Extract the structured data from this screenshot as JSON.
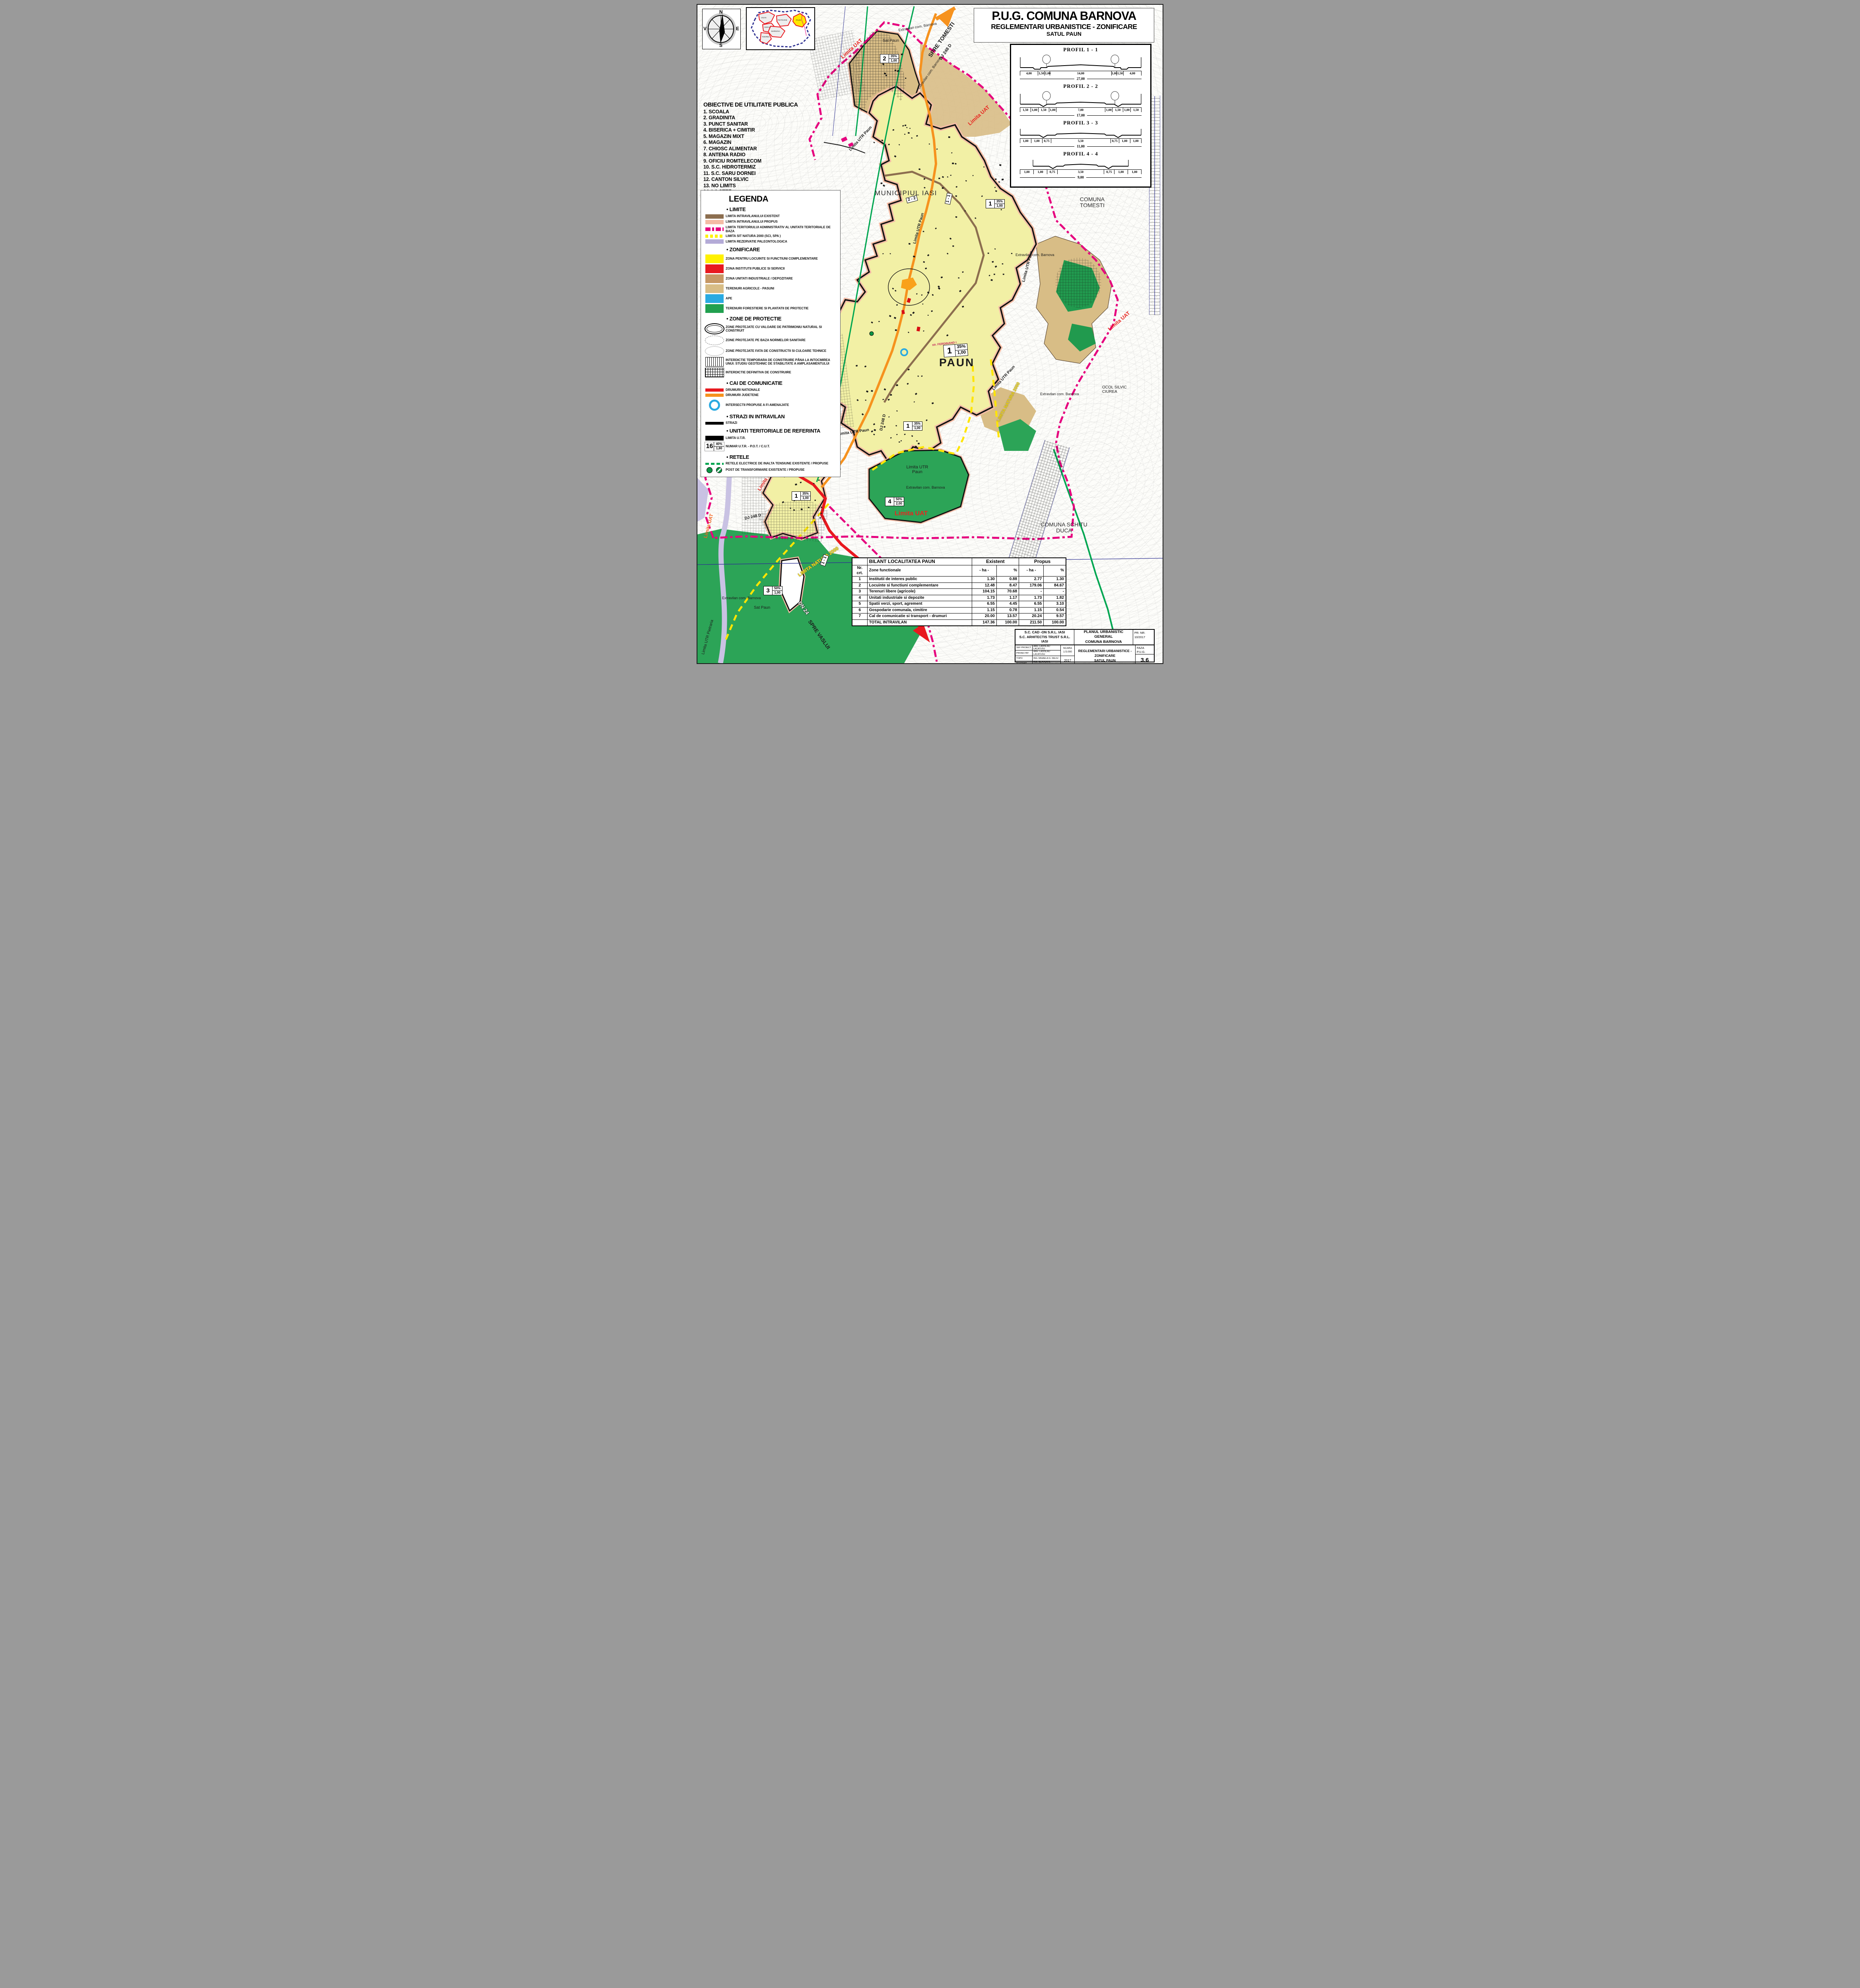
{
  "sheet": {
    "title_line1": "P.U.G. COMUNA BARNOVA",
    "title_line2": "REGLEMENTARI URBANISTICE - ZONIFICARE",
    "title_line3": "SATUL PAUN"
  },
  "compass": {
    "n": "N",
    "e": "E",
    "s": "S",
    "v": "V"
  },
  "inset_map": {
    "labels": [
      "VISAN",
      "CERCU",
      "PIETRARIE",
      "BARNOVA",
      "TODIREL",
      "PAUN"
    ]
  },
  "objectives": {
    "heading": "OBIECTIVE DE UTILITATE PUBLICA",
    "items": [
      "1. SCOALA",
      "2. GRADINITA",
      "3. PUNCT SANITAR",
      "4. BISERICA + CIMITIR",
      "5. MAGAZIN MIXT",
      "6. MAGAZIN",
      "7. CHIOSC ALIMENTAR",
      "8. ANTENA RADIO",
      "9. OFICIU ROMTELECOM",
      "10. S.C. HIDROTERMIZ",
      "11. S.C. SARU DORNEI",
      "12. CANTON SILVIC",
      "13. NO LIMITS",
      "14. LA STEF"
    ]
  },
  "profiles": {
    "items": [
      {
        "name": "PROFIL 1 - 1",
        "dims": [
          "4,00",
          "1,50",
          "1,00",
          "14,00",
          "1,00",
          "1,50",
          "4,00"
        ],
        "total": "27,00"
      },
      {
        "name": "PROFIL 2 - 2",
        "dims": [
          "1,50",
          "1,00",
          "1,50",
          "1,00",
          "7,00",
          "1,00",
          "1,50",
          "1,00",
          "1,50"
        ],
        "total": "17,00"
      },
      {
        "name": "PROFIL 3 - 3",
        "dims": [
          "1,00",
          "1,00",
          "0,75",
          "5,50",
          "0,75",
          "1,00",
          "1,00"
        ],
        "total": "11,00"
      },
      {
        "name": "PROFIL 4 - 4",
        "dims": [
          "1,00",
          "1,00",
          "0,75",
          "3,50",
          "0,75",
          "1,00",
          "1,00"
        ],
        "total": "9,00"
      }
    ]
  },
  "legend": {
    "heading": "LEGENDA",
    "h_limite": "• LIMITE",
    "limite": [
      {
        "label": "LIMITA INTRAVILANULUI EXISTENT",
        "swatch": "bar-brown"
      },
      {
        "label": "LIMITA INTRAVILANULUI PROPUS",
        "swatch": "bar-salmon"
      },
      {
        "label": "LIMITA TERITORIULUI ADMINISTRATIV AL UNITATII TERITORIALE DE BAZA",
        "swatch": "dash-magenta"
      },
      {
        "label": "LIMITA SIT NATURA 2000 (SCI, SPA )",
        "swatch": "dash-yellow"
      },
      {
        "label": "LIMITA REZERVATIE PALEONTOLOGICA",
        "swatch": "bar-lavender"
      }
    ],
    "h_zonificare": "• ZONIFICARE",
    "zonificare": [
      {
        "label": "ZONA PENTRU LOCUINTE SI FUNCTIUNI COMPLEMENTARE",
        "swatch": "fill-yellow"
      },
      {
        "label": "ZONA INSTITUTII PUBLICE SI SERVICII",
        "swatch": "fill-red"
      },
      {
        "label": "ZONA UNITATI INDUSTRIALE / DEPOZITARE",
        "swatch": "fill-indbrown"
      },
      {
        "label": "TERENURI AGRICOLE - PASUNI",
        "swatch": "fill-tan"
      },
      {
        "label": "APE",
        "swatch": "fill-blue"
      },
      {
        "label": "TERENURI FORESTIERE SI PLANTATII DE PROTECTIE",
        "swatch": "fill-green"
      }
    ],
    "h_protectie": "• ZONE DE PROTECTIE",
    "protectie": [
      {
        "label": "ZONE PROTEJATE CU VALOARE DE PATRIMONIU NATURAL SI CONSTRUIT",
        "swatch": "ellipse-plain"
      },
      {
        "label": "ZONE PROTEJATE PE BAZA NORMELOR SANITARE",
        "swatch": "ellipse-x"
      },
      {
        "label": "ZONE PROTEJATE FATA DE CONSTRUCTII SI CULOARE TEHNICE",
        "swatch": "ellipse-o"
      },
      {
        "label": "INTERDICTIE TEMPORARA DE CONSTRUIRE PÂNA LA INTOCMIREA UNUI: STUDIU GEOTEHNIC DE STABILITATE A AMPLASAMENTULUI",
        "swatch": "hatch-vert"
      },
      {
        "label": "INTERDICTIE DEFINITIVA DE CONSTRUIRE",
        "swatch": "hatch-grid-sw"
      }
    ],
    "h_cai": "• CAI DE COMUNICATIE",
    "cai": [
      {
        "label": "DRUMURI NATIONALE",
        "swatch": "bar-red-road"
      },
      {
        "label": "DRUMURI JUDETENE",
        "swatch": "bar-orange-road"
      }
    ],
    "intersectii": [
      {
        "label": "INTERSECTII PROPUSE A FI AMENAJATE",
        "swatch": "circle-blue"
      }
    ],
    "h_strazi": "• STRAZI IN INTRAVILAN",
    "strazi": [
      {
        "label": "STRAZI",
        "swatch": "bar-black"
      }
    ],
    "h_utr": "• UNITATI TERITORIALE DE REFERINTA",
    "utr": [
      {
        "label": "LIMITA U.T.R.",
        "swatch": "bar-black-thick"
      }
    ],
    "utr_sample": {
      "nr": "16",
      "pot": "40%",
      "cut": "1,80"
    },
    "utr_sample_label": "NUMAR U.T.R. - P.O.T. / C.U.T.",
    "h_retele": "• RETELE",
    "retele": [
      {
        "label": "RETELE ELECTRICE DE INALTA TENSIUNE EXISTENTE / PROPUSE",
        "swatch": "dash-green"
      },
      {
        "label": "POST DE TRANSFORMARE EXISTENTE / PROPUSE",
        "swatch": "posts"
      }
    ]
  },
  "map": {
    "labels": {
      "municipiul_iasi": "MUNICIPIUL IASI",
      "comuna_tomesti": "COMUNA TOMESTI",
      "comuna_schitu_duca": "COMUNA SCHITU DUCA",
      "paun": "PAUN",
      "sat_paun": "Sat Paun",
      "spre_tomesti": "SPRE TOMESTI",
      "spre_iasi": "SPRE IASI",
      "spre_vaslui": "SPRE VASLUI",
      "dn24": "DN 24",
      "dj248d": "DJ 248 D",
      "limita_uat": "Limita UAT",
      "limita_utr_paun": "Limita UTR Paun",
      "limita_utr_pietraria": "Limita UTR Pietraria",
      "extravilan": "Extravilan com. Barnova",
      "limita_natura": "LIMITA NATURA 2000",
      "ocol_silvic": "OCOL SILVIC CIUREA",
      "str_ferdinand": "str. FERDINAND I",
      "pd_sandulea": "pd. Sandulea"
    },
    "utr_markers": {
      "m1": {
        "nr": "1",
        "pot": "35%",
        "cut": "1,00"
      },
      "m2": {
        "nr": "2",
        "pot": "35%",
        "cut": "1,00"
      },
      "m3": {
        "nr": "3",
        "pot": "50%",
        "cut": "1,00"
      },
      "m4": {
        "nr": "4",
        "pot": "50%",
        "cut": "2,00"
      }
    },
    "profile_markers": {
      "p11": "1 - 1",
      "p22": "2 - 2"
    }
  },
  "table": {
    "title": "BILANT LOCALITATEA PAUN",
    "col_existent": "Existent",
    "col_propus": "Propus",
    "col_nr": "Nr. crt.",
    "col_zone": "Zone functionale",
    "col_ha_e": "- ha -",
    "col_pct_e": "%",
    "col_ha_p": "- ha -",
    "col_pct_p": "%",
    "rows": [
      {
        "nr": "1",
        "zone": "Institutii de interes public",
        "e_ha": "1.30",
        "e_pct": "0.88",
        "p_ha": "2.77",
        "p_pct": "1.30"
      },
      {
        "nr": "2",
        "zone": "Locuinte si functiuni complementare",
        "e_ha": "12.48",
        "e_pct": "8.47",
        "p_ha": "179.06",
        "p_pct": "84.67"
      },
      {
        "nr": "3",
        "zone": "Terenuri libere (agricole)",
        "e_ha": "104.15",
        "e_pct": "70.68",
        "p_ha": "-",
        "p_pct": "-"
      },
      {
        "nr": "4",
        "zone": "Unitati industriale si depozite",
        "e_ha": "1.73",
        "e_pct": "1.17",
        "p_ha": "1.73",
        "p_pct": "1.82"
      },
      {
        "nr": "5",
        "zone": "Spatii verzi, sport, agrement",
        "e_ha": "6.55",
        "e_pct": "4.45",
        "p_ha": "6.55",
        "p_pct": "3.10"
      },
      {
        "nr": "6",
        "zone": "Gospodarie comunala, cimitire",
        "e_ha": "1.15",
        "e_pct": "0.78",
        "p_ha": "1.15",
        "p_pct": "0.54"
      },
      {
        "nr": "7",
        "zone": "Cal de comunicatie si transport - drumuri",
        "e_ha": "20.00",
        "e_pct": "13.57",
        "p_ha": "20.24",
        "p_pct": "9.57"
      }
    ],
    "total": {
      "zone": "TOTAL INTRAVILAN",
      "e_ha": "147.36",
      "e_pct": "100.00",
      "p_ha": "211.50",
      "p_pct": "100.00"
    }
  },
  "titleblock": {
    "company1": "S.C. CAD -ON S.R.L. IASI",
    "company2": "S.C. ARHITECTIS TRUST S.R.L. IASI",
    "plan1": "PLANUL URBANISTIC GENERAL",
    "plan2": "COMUNA BARNOVA",
    "pr_label": "PR. NR.",
    "pr_value": "10/2017",
    "staff": [
      {
        "role": "SEF PROIECT",
        "name": "ARH. LADISLAU LACATUSU"
      },
      {
        "role": "PROIECTAT",
        "name": "ARH. LADISLAU LACATUSU"
      },
      {
        "role": "TOPO",
        "name": "ING. MIHAELA G. DELIU"
      },
      {
        "role": "DESENAT",
        "name": "ING. CLAVIUS B. PARFENE"
      }
    ],
    "scara_label": "SCARA",
    "scara_value": "1:5.000",
    "year": "2017",
    "sheet1": "REGLEMENTARI URBANISTICE - ZONIFICARE",
    "sheet2": "SATUL PAUN",
    "faza_label": "FAZA",
    "faza_value": "P.U.G.",
    "plansa": "3.6"
  }
}
